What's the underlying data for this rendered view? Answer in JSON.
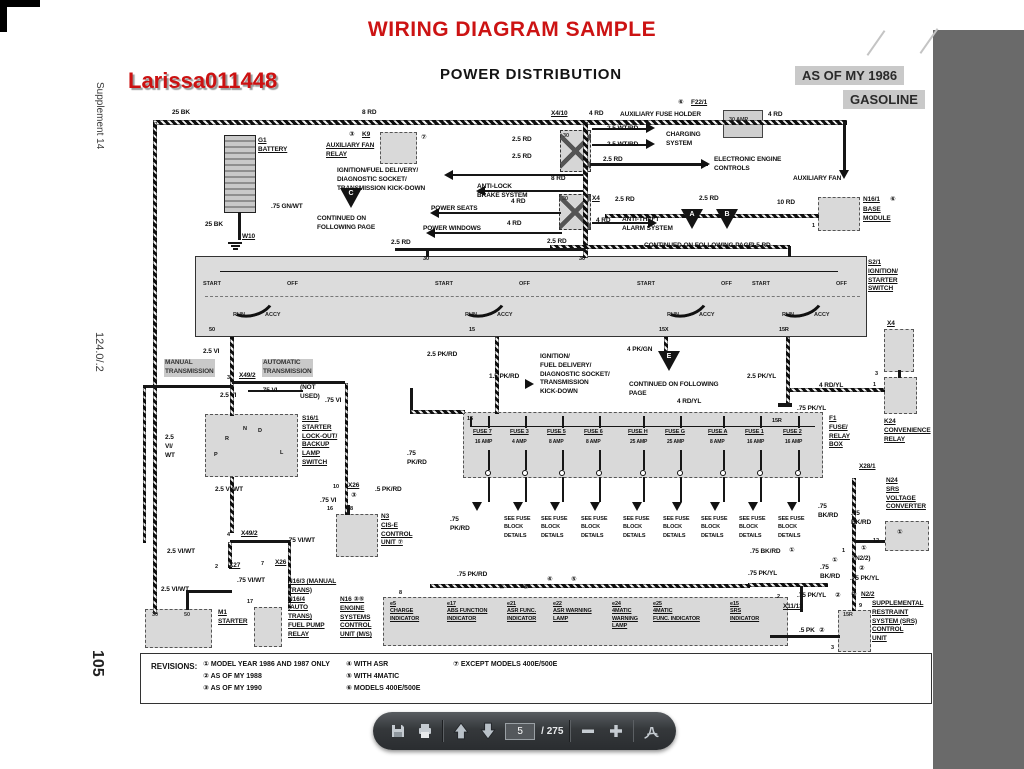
{
  "header": {
    "title": "WIRING DIAGRAM SAMPLE",
    "watermark": "Larissa011448",
    "diagram_title": "POWER DISTRIBUTION",
    "badge_model_year": "AS OF MY 1986",
    "badge_fuel": "GASOLINE"
  },
  "margin": {
    "supplement": "Supplement 14",
    "chassis": "124.0/.2",
    "page_no": "105"
  },
  "diagram": {
    "boxes": [
      [
        224,
        135,
        32,
        78,
        "bat"
      ],
      [
        380,
        132,
        37,
        32,
        "gd"
      ],
      [
        560,
        130,
        31,
        42,
        "jx"
      ],
      [
        559,
        194,
        32,
        36,
        "jx"
      ],
      [
        723,
        110,
        40,
        28,
        "g"
      ],
      [
        818,
        197,
        42,
        34,
        "gd"
      ],
      [
        195,
        256,
        672,
        81,
        "band"
      ],
      [
        205,
        414,
        93,
        63,
        "gd"
      ],
      [
        463,
        412,
        360,
        66,
        "gd"
      ],
      [
        884,
        329,
        30,
        43,
        "gd"
      ],
      [
        884,
        377,
        33,
        37,
        "gd"
      ],
      [
        885,
        521,
        44,
        30,
        "gd"
      ],
      [
        838,
        610,
        33,
        42,
        "gd"
      ],
      [
        145,
        609,
        67,
        39,
        "gd"
      ],
      [
        254,
        607,
        28,
        40,
        "gd"
      ],
      [
        336,
        514,
        42,
        43,
        "gd"
      ],
      [
        383,
        597,
        405,
        49,
        "gd"
      ]
    ],
    "wires": [
      [
        153,
        120,
        694,
        5,
        1
      ],
      [
        153,
        122,
        4,
        492,
        1
      ],
      [
        238,
        212,
        3,
        28,
        0
      ],
      [
        583,
        122,
        5,
        136,
        1
      ],
      [
        843,
        122,
        3,
        52,
        0
      ],
      [
        590,
        163,
        118,
        3,
        0
      ],
      [
        450,
        174,
        133,
        2,
        0
      ],
      [
        482,
        190,
        101,
        2,
        0
      ],
      [
        436,
        212,
        125,
        2,
        0
      ],
      [
        432,
        232,
        130,
        2,
        0
      ],
      [
        592,
        222,
        62,
        2,
        0
      ],
      [
        605,
        214,
        214,
        4,
        1
      ],
      [
        550,
        245,
        240,
        4,
        1
      ],
      [
        395,
        248,
        190,
        3,
        0
      ],
      [
        426,
        250,
        3,
        7,
        0
      ],
      [
        788,
        246,
        3,
        11,
        0
      ],
      [
        230,
        337,
        4,
        79,
        1
      ],
      [
        143,
        385,
        90,
        3,
        0
      ],
      [
        143,
        387,
        3,
        156,
        1
      ],
      [
        248,
        390,
        55,
        2,
        0
      ],
      [
        232,
        381,
        113,
        3,
        0
      ],
      [
        345,
        383,
        3,
        132,
        1
      ],
      [
        230,
        477,
        4,
        56,
        1
      ],
      [
        230,
        540,
        60,
        3,
        0
      ],
      [
        288,
        542,
        3,
        66,
        1
      ],
      [
        228,
        542,
        4,
        26,
        1
      ],
      [
        186,
        590,
        46,
        3,
        0
      ],
      [
        186,
        592,
        3,
        18,
        0
      ],
      [
        495,
        337,
        4,
        77,
        1
      ],
      [
        410,
        388,
        3,
        24,
        0
      ],
      [
        410,
        410,
        55,
        4,
        1
      ],
      [
        664,
        337,
        4,
        15,
        1
      ],
      [
        786,
        337,
        4,
        67,
        1
      ],
      [
        790,
        388,
        95,
        4,
        1
      ],
      [
        778,
        403,
        14,
        4,
        0
      ],
      [
        898,
        370,
        3,
        8,
        0
      ],
      [
        852,
        478,
        4,
        133,
        1
      ],
      [
        855,
        540,
        30,
        3,
        0
      ],
      [
        748,
        583,
        80,
        4,
        1
      ],
      [
        800,
        586,
        3,
        26,
        0
      ],
      [
        430,
        584,
        320,
        4,
        1
      ],
      [
        770,
        635,
        70,
        3,
        0
      ],
      [
        592,
        128,
        56,
        2,
        0
      ],
      [
        592,
        144,
        56,
        2,
        0
      ],
      [
        470,
        426,
        345,
        1,
        0
      ],
      [
        470,
        417,
        2,
        10,
        0
      ],
      [
        220,
        271,
        618,
        1,
        0
      ],
      [
        205,
        296,
        655,
        1,
        2
      ],
      [
        347,
        505,
        3,
        10,
        0
      ]
    ],
    "labels": [
      [
        "25 BK",
        172,
        109
      ],
      [
        "8 RD",
        362,
        109
      ],
      [
        "G1\nBATTERY",
        258,
        137,
        "u"
      ],
      [
        "③",
        349,
        131
      ],
      [
        "K9",
        362,
        131,
        "u"
      ],
      [
        "AUXILIARY FAN\nRELAY",
        326,
        142,
        "u"
      ],
      [
        "⑦",
        421,
        134
      ],
      [
        "X4/10",
        551,
        110,
        "u"
      ],
      [
        "4 RD",
        589,
        110
      ],
      [
        "AUXILIARY FUSE HOLDER",
        620,
        111
      ],
      [
        "⑥",
        678,
        99
      ],
      [
        "F22/1",
        691,
        99,
        "u"
      ],
      [
        "30 AMP",
        729,
        117,
        "pw"
      ],
      [
        "4 RD",
        768,
        111
      ],
      [
        "2.5 RD",
        512,
        136
      ],
      [
        "2.5 RD",
        512,
        153
      ],
      [
        "2.5 WT/RD",
        607,
        125
      ],
      [
        "2.5 WT/RD",
        607,
        141
      ],
      [
        "CHARGING\nSYSTEM",
        666,
        131
      ],
      [
        "2.5 RD",
        603,
        156
      ],
      [
        "ELECTRONIC ENGINE\nCONTROLS",
        714,
        156
      ],
      [
        "AUXILIARY FAN",
        793,
        175
      ],
      [
        "8 RD",
        551,
        175
      ],
      [
        "X4",
        592,
        195,
        "u"
      ],
      [
        "2.5 RD",
        615,
        196
      ],
      [
        "2.5 RD",
        699,
        195
      ],
      [
        "IGNITION/FUEL DELIVERY/\nDIAGNOSTIC SOCKET/\nTRANSMISSION KICK-DOWN",
        337,
        167
      ],
      [
        "ANTI-LOCK\nBRAKE SYSTEM",
        477,
        183
      ],
      [
        "4 RD",
        511,
        198
      ],
      [
        "POWER SEATS",
        431,
        205
      ],
      [
        "4 RD",
        507,
        220
      ],
      [
        "POWER WINDOWS",
        423,
        225
      ],
      [
        "4 RD",
        596,
        217
      ],
      [
        "ANTI-THEFT\nALARM SYSTEM",
        622,
        216
      ],
      [
        "10 RD",
        777,
        199
      ],
      [
        "N16/1",
        863,
        196,
        "u"
      ],
      [
        "⑥",
        890,
        196
      ],
      [
        "BASE\nMODULE",
        863,
        206,
        "u"
      ],
      [
        "1",
        812,
        223,
        "p"
      ],
      [
        ".75 GN/WT",
        271,
        203
      ],
      [
        "CONTINUED ON\nFOLLOWING PAGE",
        317,
        215
      ],
      [
        "25 BK",
        205,
        221
      ],
      [
        "W10",
        242,
        233,
        "u"
      ],
      [
        "2.5 RD",
        391,
        239
      ],
      [
        "2.5 RD",
        547,
        238
      ],
      [
        "2.5 RD",
        751,
        242
      ],
      [
        "CONTINUED ON FOLLOWING PAGE",
        644,
        242
      ],
      [
        "30",
        423,
        256,
        "p"
      ],
      [
        "30",
        579,
        256,
        "p"
      ],
      [
        "30",
        563,
        133,
        "pw"
      ],
      [
        "30",
        562,
        196,
        "pw"
      ],
      [
        "S2/1\nIGNITION/\nSTARTER\nSWITCH",
        868,
        259,
        "u"
      ],
      [
        "50",
        209,
        327,
        "p"
      ],
      [
        "15",
        469,
        327,
        "p"
      ],
      [
        "15X",
        659,
        327,
        "p"
      ],
      [
        "15R",
        779,
        327,
        "p"
      ],
      [
        "2.5 VI",
        203,
        348
      ],
      [
        "MANUAL\nTRANSMISSION",
        164,
        359,
        "hl"
      ],
      [
        "3",
        227,
        375,
        "p"
      ],
      [
        "X49/2",
        239,
        372,
        "u"
      ],
      [
        "AUTOMATIC\nTRANSMISSION",
        262,
        359,
        "hl"
      ],
      [
        "2.5 VI",
        220,
        392
      ],
      [
        ".75 VI",
        261,
        387
      ],
      [
        "(NOT\nUSED)",
        300,
        384
      ],
      [
        ".75 VI",
        325,
        397
      ],
      [
        "S16/1\nSTARTER\nLOCK-OUT/\nBACKUP\nLAMP\nSWITCH",
        302,
        415,
        "u"
      ],
      [
        "2.5\nVI/\nWT",
        165,
        434
      ],
      [
        "R",
        225,
        436,
        "p"
      ],
      [
        "N",
        243,
        426,
        "p"
      ],
      [
        "D",
        258,
        428,
        "p"
      ],
      [
        "P",
        214,
        452,
        "p"
      ],
      [
        "L",
        280,
        450,
        "p"
      ],
      [
        "2.5 VI/WT",
        215,
        486
      ],
      [
        "10",
        333,
        484,
        "p"
      ],
      [
        "X26",
        348,
        482,
        "u"
      ],
      [
        "③",
        351,
        492
      ],
      [
        ".75 VI",
        320,
        497
      ],
      [
        "16",
        327,
        506,
        "p"
      ],
      [
        "28",
        347,
        506,
        "p"
      ],
      [
        ".5 PK/RD",
        375,
        486
      ],
      [
        "N3\nCIS-E\nCONTROL\nUNIT ⑦",
        381,
        513,
        "u"
      ],
      [
        "4",
        227,
        532,
        "p"
      ],
      [
        "X49/2",
        241,
        530,
        "u"
      ],
      [
        ".75 VI/WT",
        287,
        537
      ],
      [
        "2.5 VI/WT",
        167,
        548
      ],
      [
        "2",
        215,
        564,
        "p"
      ],
      [
        "X27",
        229,
        562,
        "u"
      ],
      [
        "7",
        261,
        561,
        "p"
      ],
      [
        "X26",
        275,
        559,
        "u"
      ],
      [
        ".75 VI/WT",
        237,
        577
      ],
      [
        "2.5 VI/WT",
        161,
        586
      ],
      [
        "M1\nSTARTER",
        218,
        609,
        "u"
      ],
      [
        "30",
        152,
        612,
        "pw"
      ],
      [
        "50",
        184,
        612,
        "pw"
      ],
      [
        "17",
        247,
        599,
        "p"
      ],
      [
        "N16/3 (MANUAL\nTRANS)\nN16/4\n(AUTO\nTRANS)\nFUEL PUMP\nRELAY",
        288,
        578,
        "u"
      ],
      [
        "N16 ③⑤\nENGINE\nSYSTEMS\nCONTROL\nUNIT (M/S)",
        340,
        596,
        "u"
      ],
      [
        "8",
        399,
        590,
        "p"
      ],
      [
        "2.5 PK/RD",
        427,
        351
      ],
      [
        "1.5 PK/RD",
        489,
        373
      ],
      [
        "IGNITION/\nFUEL DELIVERY/\nDIAGNOSTIC SOCKET/\nTRANSMISSION\nKICK-DOWN",
        540,
        353
      ],
      [
        "4 PK/GN",
        627,
        346
      ],
      [
        "CONTINUED ON FOLLOWING\nPAGE",
        629,
        381
      ],
      [
        "2.5 PK/YL",
        747,
        373
      ],
      [
        "4 RD/YL",
        677,
        398
      ],
      [
        "4 RD/YL",
        819,
        382
      ],
      [
        ".75 PK/YL",
        797,
        405
      ],
      [
        "15",
        467,
        416,
        "p"
      ],
      [
        "15R",
        772,
        418,
        "p"
      ],
      [
        "F1\nFUSE/\nRELAY\nBOX",
        829,
        415,
        "u"
      ],
      [
        ".75\nPK/RD",
        407,
        450
      ],
      [
        ".75\nPK/RD",
        450,
        516
      ],
      [
        ".75 BK/RD",
        750,
        548
      ],
      [
        "①",
        789,
        547
      ],
      [
        ".75 PK/YL",
        748,
        570
      ],
      [
        ".75 PK/RD",
        457,
        571
      ],
      [
        "④",
        499,
        584
      ],
      [
        "⑤",
        523,
        584
      ],
      [
        "④",
        547,
        576
      ],
      [
        "⑤",
        571,
        576
      ],
      [
        "X4",
        887,
        320,
        "u"
      ],
      [
        "3",
        875,
        371,
        "p"
      ],
      [
        "1",
        873,
        382,
        "p"
      ],
      [
        "K24\nCONVENIENCE\nRELAY",
        884,
        418,
        "u"
      ],
      [
        "X28/1",
        859,
        463,
        "u"
      ],
      [
        "N24\nSRS\nVOLTAGE\nCONVERTER",
        886,
        477,
        "u"
      ],
      [
        ".75\nBK/RD",
        818,
        503
      ],
      [
        ".75\nBK/RD",
        851,
        510
      ],
      [
        "12",
        873,
        538,
        "p"
      ],
      [
        "①",
        897,
        529
      ],
      [
        "1",
        842,
        548,
        "p"
      ],
      [
        "①",
        861,
        545
      ],
      [
        "(N2/2)",
        853,
        555
      ],
      [
        "①",
        832,
        557
      ],
      [
        ".75\nBK/RD",
        820,
        564
      ],
      [
        "②",
        859,
        565
      ],
      [
        ".75 PK/YL",
        850,
        575
      ],
      [
        "2",
        777,
        594,
        "p"
      ],
      [
        "X11/13",
        783,
        603,
        "u"
      ],
      [
        ".75 PK/YL",
        797,
        592
      ],
      [
        "②",
        835,
        592
      ],
      [
        "②",
        851,
        591
      ],
      [
        "N2/2",
        861,
        591,
        "u"
      ],
      [
        "9",
        859,
        603,
        "p"
      ],
      [
        "SUPPLEMENTAL\nRESTRAINT\nSYSTEM (SRS)\nCONTROL\nUNIT",
        872,
        600,
        "u"
      ],
      [
        "15R",
        843,
        612,
        "pw"
      ],
      [
        ".5 PK",
        799,
        627
      ],
      [
        "②",
        819,
        627
      ],
      [
        "3",
        831,
        645,
        "p"
      ]
    ],
    "arrows": [
      [
        "l",
        444,
        170
      ],
      [
        "l",
        476,
        186
      ],
      [
        "l",
        430,
        208
      ],
      [
        "l",
        426,
        228
      ],
      [
        "r",
        646,
        123
      ],
      [
        "r",
        646,
        139
      ],
      [
        "r",
        701,
        159
      ],
      [
        "r",
        648,
        218
      ],
      [
        "r",
        525,
        379
      ],
      [
        "d",
        839,
        170
      ],
      [
        "d",
        472,
        502
      ],
      [
        "d",
        513,
        502
      ],
      [
        "d",
        550,
        502
      ],
      [
        "d",
        590,
        502
      ],
      [
        "d",
        632,
        502
      ],
      [
        "d",
        672,
        502
      ],
      [
        "d",
        710,
        502
      ],
      [
        "d",
        748,
        502
      ],
      [
        "d",
        787,
        502
      ]
    ],
    "triangles": [
      [
        "C",
        340,
        188
      ],
      [
        "A",
        681,
        209
      ],
      [
        "B",
        716,
        209
      ],
      [
        "E",
        658,
        351
      ]
    ],
    "band": {
      "group_x": [
        203,
        435,
        637,
        752
      ],
      "positions": {
        "start": "START",
        "off": "OFF",
        "run": "RUN",
        "accy": "ACCY"
      }
    },
    "fusebox": {
      "fuses": [
        [
          "FUSE 7",
          "16 AMP",
          489
        ],
        [
          "FUSE 3",
          "4 AMP",
          526
        ],
        [
          "FUSE 5",
          "8 AMP",
          563
        ],
        [
          "FUSE 6",
          "8 AMP",
          600
        ],
        [
          "FUSE H",
          "25 AMP",
          644
        ],
        [
          "FUSE G",
          "25 AMP",
          681
        ],
        [
          "FUSE A",
          "8 AMP",
          724
        ],
        [
          "FUSE 1",
          "16 AMP",
          761
        ],
        [
          "FUSE 2",
          "16 AMP",
          799
        ]
      ]
    },
    "see_fuse": {
      "lines": "SEE FUSE\nBLOCK\nDETAILS",
      "xs": [
        504,
        541,
        581,
        623,
        663,
        701,
        739,
        778
      ],
      "y": 515
    },
    "indicators": {
      "y": 601,
      "items": [
        [
          "e5",
          "CHARGE\nINDICATOR",
          390
        ],
        [
          "e17",
          "ABS FUNCTION\nINDICATOR",
          447
        ],
        [
          "e21",
          "ASR FUNC.\nINDICATOR",
          507
        ],
        [
          "e22",
          "ASR WARNING\nLAMP",
          553
        ],
        [
          "e24",
          "4MATIC\nWARNING\nLAMP",
          612
        ],
        [
          "e25",
          "4MATIC\nFUNC. INDICATOR",
          653
        ],
        [
          "e15",
          "SRS\nINDICATOR",
          730
        ]
      ]
    },
    "ground": {
      "x": 228,
      "y": 242
    }
  },
  "revisions": {
    "heading": "REVISIONS:",
    "col_x": [
      62,
      205,
      312
    ],
    "cols": [
      [
        "①  MODEL YEAR 1986 AND 1987 ONLY",
        "②  AS OF MY 1988",
        "③  AS OF MY 1990"
      ],
      [
        "④  WITH ASR",
        "⑤  WITH 4MATIC",
        "⑥  MODELS 400E/500E"
      ],
      [
        "⑦  EXCEPT MODELS 400E/500E"
      ]
    ]
  },
  "toolbar": {
    "page_input": "5",
    "page_count": "/ 275"
  }
}
